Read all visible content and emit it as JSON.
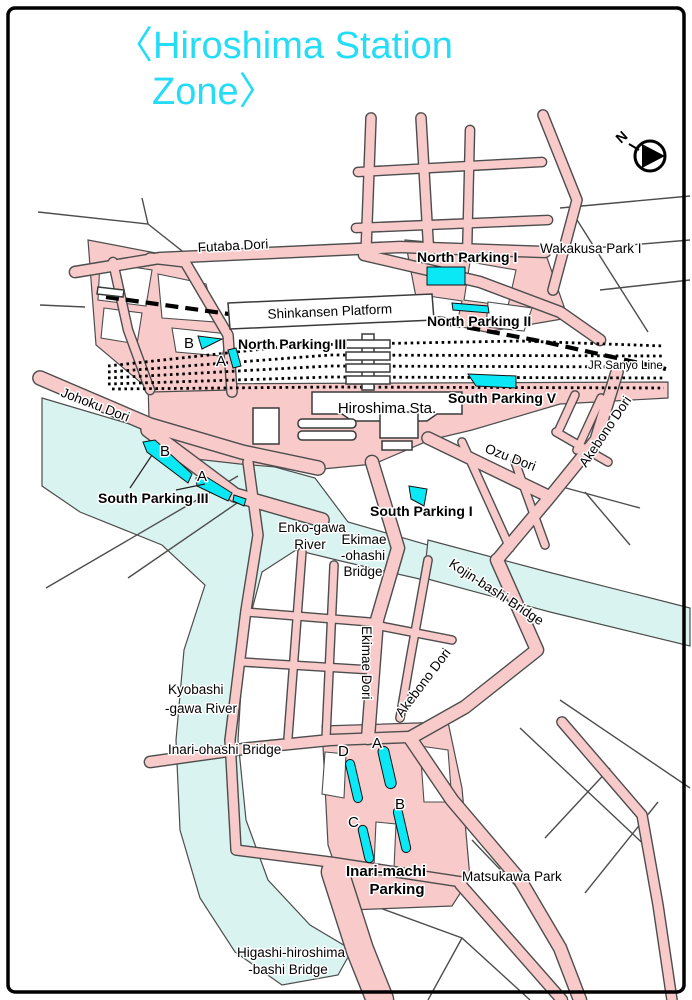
{
  "title": {
    "line1": "〈Hiroshima Station",
    "line2": "Zone〉"
  },
  "compass": {
    "label": "N"
  },
  "streets": {
    "futaba": "Futaba Dori",
    "johoku": "Johoku Dori",
    "ozu": "Ozu Dori",
    "akebono_upper": "Akebono Dori",
    "akebono_lower": "Akebono Dori",
    "ekimae": "Ekimae Dori",
    "jr_sanyo": "JR Sanyo Line"
  },
  "station": {
    "shinkansen_platform": "Shinkansen Platform",
    "hiroshima_sta": "Hiroshima Sta."
  },
  "parks": {
    "wakakusa": "Wakakusa Park I",
    "matsukawa": "Matsukawa Park"
  },
  "parking": {
    "north_1": {
      "label": "North Parking I"
    },
    "north_2": {
      "label": "North Parking II"
    },
    "north_3": {
      "label": "North Parking III",
      "markers": [
        "B",
        "A"
      ]
    },
    "south_1": {
      "label": "South Parking I"
    },
    "south_3": {
      "label": "South Parking III",
      "markers": [
        "B",
        "A"
      ]
    },
    "south_5": {
      "label": "South Parking V"
    },
    "inari_machi": {
      "label_line1": "Inari-machi",
      "label_line2": "Parking",
      "lots": [
        "D",
        "A",
        "B",
        "C"
      ]
    }
  },
  "bridges": {
    "ekimae_ohashi": [
      "Ekimae",
      "-ohashi",
      "Bridge"
    ],
    "kojin": "Kojin-bashi Bridge",
    "inari_ohashi": "Inari-ohashi Bridge",
    "higashi": [
      "Higashi-hiroshima",
      "-bashi Bridge"
    ]
  },
  "rivers": {
    "enko": [
      "Enko-gawa",
      "River"
    ],
    "kyobashi": [
      "Kyobashi",
      "-gawa River"
    ]
  },
  "colors": {
    "title_cyan": "#25dcf7",
    "road_pink": "#f8caca",
    "road_outline": "#4d4d4d",
    "river_cyan": "#d9f4f0",
    "parking_cyan": "#0ae8f6",
    "rail_black": "#000000",
    "text_black": "#000000",
    "background": "#ffffff",
    "border_black": "#000000"
  }
}
